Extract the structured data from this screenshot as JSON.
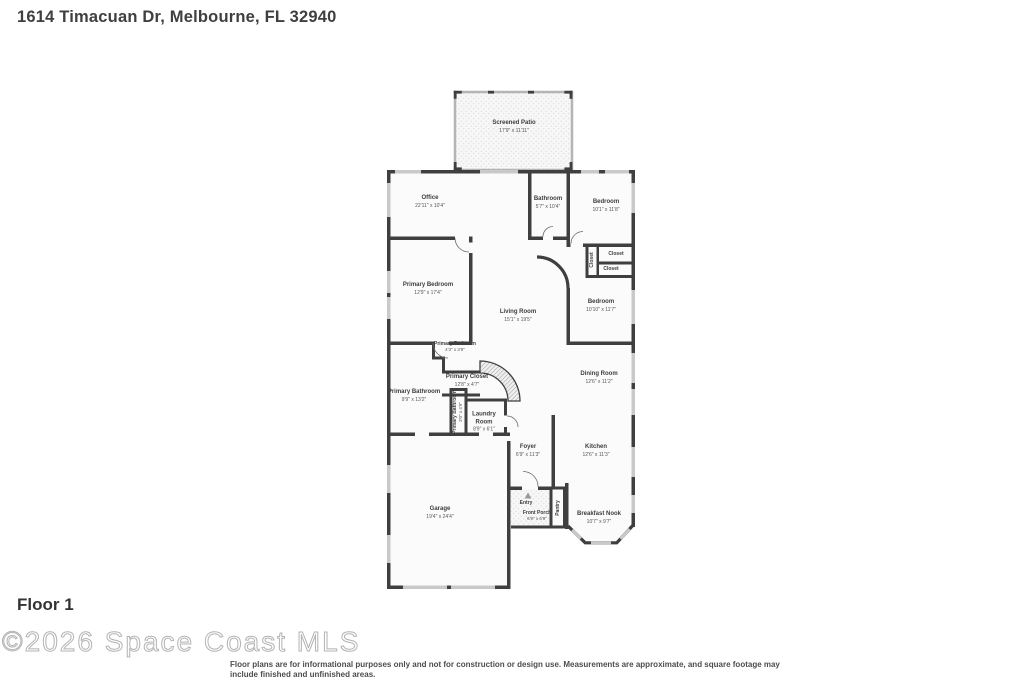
{
  "header": {
    "title": "1614 Timacuan Dr, Melbourne, FL 32940"
  },
  "footer": {
    "floor_label": "Floor 1",
    "watermark": "©2026 Space Coast MLS",
    "disclaimer": "Floor plans are for informational purposes only and not for construction or design use. Measurements are approximate, and square footage may include finished and unfinished areas."
  },
  "colors": {
    "wall": "#3f3f3f",
    "window": "#c9c9c9",
    "patio_wall": "#b5b5b5",
    "interior_fill": "#fbfbfb",
    "label_text": "#3d3d3d"
  },
  "floorplan": {
    "rooms": [
      {
        "name": "Screened Patio",
        "dims": "17'9\" x 11'11\""
      },
      {
        "name": "Office",
        "dims": "22'11\" x 10'4\""
      },
      {
        "name": "Bathroom",
        "dims": "5'7\" x 10'4\""
      },
      {
        "name": "Bedroom",
        "dims": "10'1\" x 11'8\""
      },
      {
        "name": "Closet"
      },
      {
        "name": "Closet"
      },
      {
        "name": "Closet"
      },
      {
        "name": "Primary Bedroom",
        "dims": "12'9\" x 17'4\""
      },
      {
        "name": "Living Room",
        "dims": "15'1\" x 19'5\""
      },
      {
        "name": "Bedroom",
        "dims": "10'10\" x 11'7\""
      },
      {
        "name": "Primary Bedroom",
        "dims": "4'3\" x 3'9\""
      },
      {
        "name": "Primary Closet",
        "dims": "12'8\" x 4'7\""
      },
      {
        "name": "Primary Bathroom",
        "dims": "9'9\" x 13'2\""
      },
      {
        "name": "Primary Bathroom",
        "dims": "3'0\" x 4'9\""
      },
      {
        "name": "Laundry Room",
        "dims": "8'9\" x 6'1\""
      },
      {
        "name": "Dining Room",
        "dims": "12'6\" x 11'2\""
      },
      {
        "name": "Foyer",
        "dims": "6'9\" x 11'3\""
      },
      {
        "name": "Kitchen",
        "dims": "12'6\" x 11'3\""
      },
      {
        "name": "Garage",
        "dims": "19'4\" x 24'4\""
      },
      {
        "name": "Entry"
      },
      {
        "name": "Front Porch",
        "dims": "6'9\" x 6'9\""
      },
      {
        "name": "Pantry"
      },
      {
        "name": "Breakfast Nook",
        "dims": "10'7\" x 9'7\""
      }
    ]
  }
}
